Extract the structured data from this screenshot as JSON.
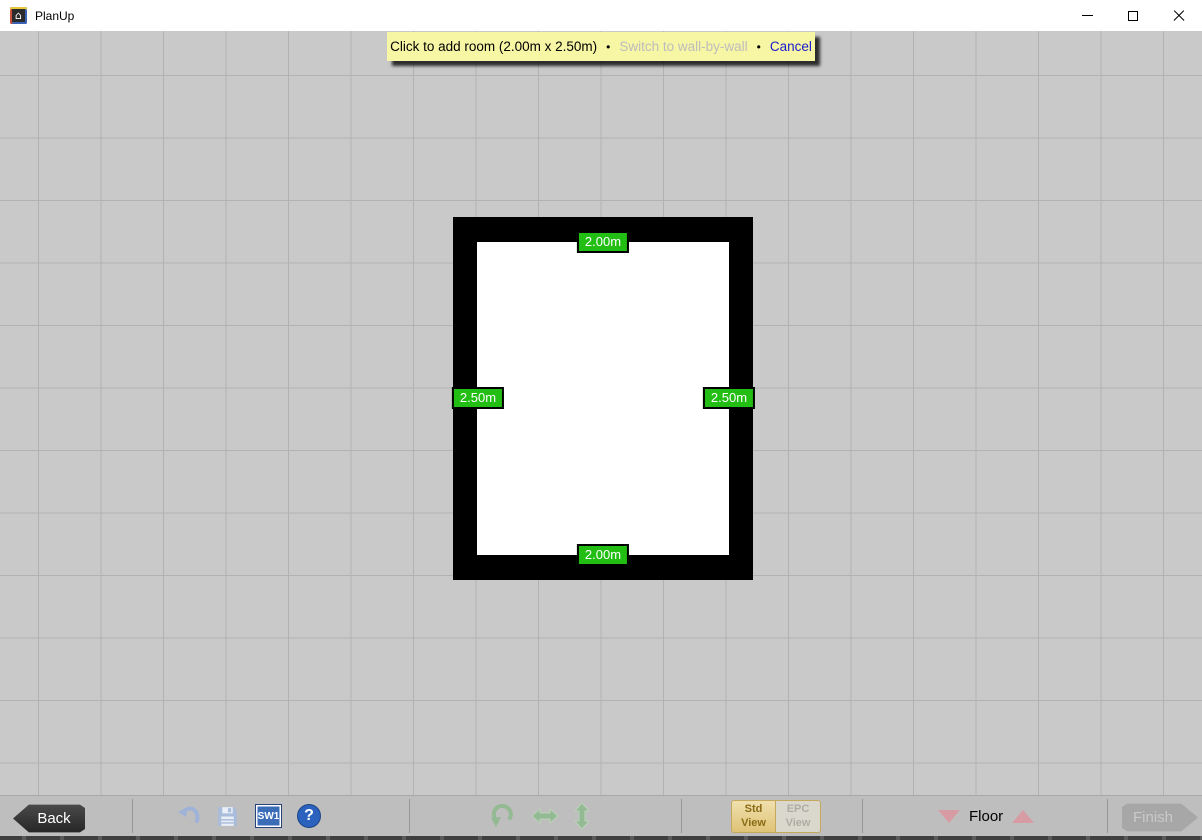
{
  "window": {
    "title": "PlanUp",
    "controls": {
      "minimize": "minimize",
      "maximize": "maximize",
      "close": "close"
    }
  },
  "banner": {
    "message": "Click to add room (2.00m x 2.50m)",
    "bullet": "•",
    "switch_link": "Switch to wall-by-wall",
    "cancel_link": "Cancel",
    "bg_color": "#F7F6A5",
    "link_color": "#1B1BD1",
    "disabled_link_color": "#BCBCBC"
  },
  "room": {
    "width_label_top": "2.00m",
    "width_label_bottom": "2.00m",
    "height_label_left": "2.50m",
    "height_label_right": "2.50m",
    "label_bg_color": "#22BE14",
    "wall_color": "#000000",
    "floor_color": "#FFFFFF"
  },
  "toolbar": {
    "back_label": "Back",
    "finish_label": "Finish",
    "sw1_label": "SW1",
    "help_glyph": "?",
    "floor_label": "Floor",
    "std_view": {
      "line1": "Std",
      "line2": "View"
    },
    "epc_view": {
      "line1": "EPC",
      "line2": "View"
    },
    "icon_names": [
      "undo-icon",
      "save-icon",
      "sw1-icon",
      "help-icon",
      "rotate-icon",
      "flip-horizontal-icon",
      "flip-vertical-icon"
    ],
    "icon_colors": {
      "undo_save_blue": "#9FB2D8",
      "green": "#93BA93",
      "floor_triangle_pink": "#D79BA3"
    }
  }
}
